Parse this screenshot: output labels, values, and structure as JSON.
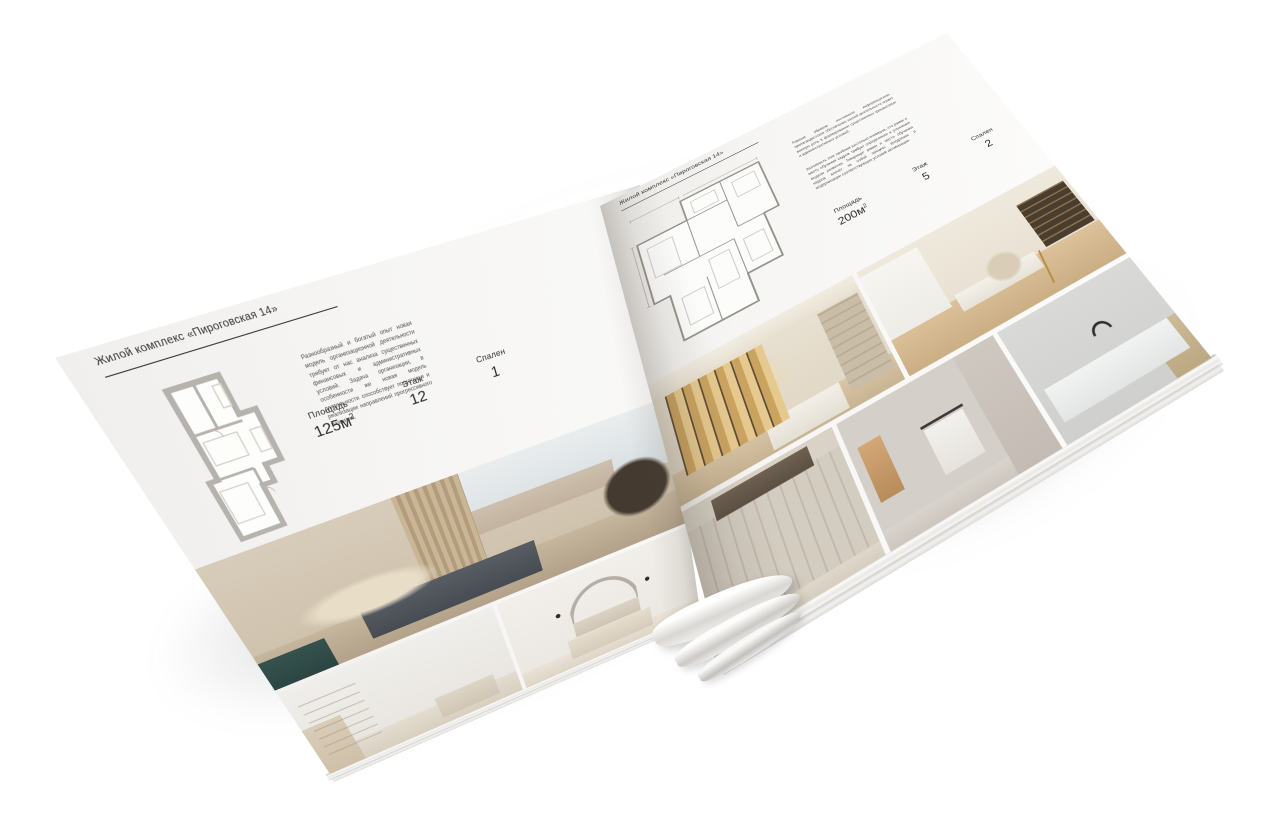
{
  "background_color": "#ffffff",
  "paper_color": "#f6f5f3",
  "accent_text_color": "#2e2e2e",
  "brochure": {
    "left_page": {
      "header": "Жилой комплекс «Пироговская 14»",
      "description": "Разнообразный и богатый опыт новая модель организационной деятельности требует от нас анализа существенных финансовых и административных условий. Задача организации, в особенности же новая модель деятельности способствует подготовке и реализации направлений прогрессивного развития.",
      "stats": [
        {
          "label": "Площадь",
          "value": "125м",
          "sup": "2"
        },
        {
          "label": "Этаж",
          "value": "12",
          "sup": ""
        },
        {
          "label": "Спален",
          "value": "1",
          "sup": ""
        }
      ],
      "photos": [
        "master-bedroom-panorama",
        "white-room-with-shelves",
        "bedroom-with-arch-decor"
      ]
    },
    "right_page": {
      "header": "Жилой комплекс «Пироговская 14»",
      "description_1": "Равным образом постоянное информационно-пропагандистское обеспечение нашей деятельности играет важную роль в формировании существенных финансовых и административных условий.",
      "description_2": "Значимость этих проблем настолько очевидна, что рамки и место обучения кадров требует определения и уточнения модели развития. Товарищи! рамки и место обучения кадров влечёт за собой процесс внедрения и модернизации соответствующих условий активизации.",
      "stats": [
        {
          "label": "Площадь",
          "value": "200м",
          "sup": "2"
        },
        {
          "label": "Этаж",
          "value": "5",
          "sup": ""
        },
        {
          "label": "Спален",
          "value": "2",
          "sup": ""
        }
      ],
      "photos": [
        "dressing-room-cabinets",
        "home-office",
        "tall-wardrobe-hall",
        "bathroom-towel",
        "laundry-counter"
      ]
    }
  }
}
